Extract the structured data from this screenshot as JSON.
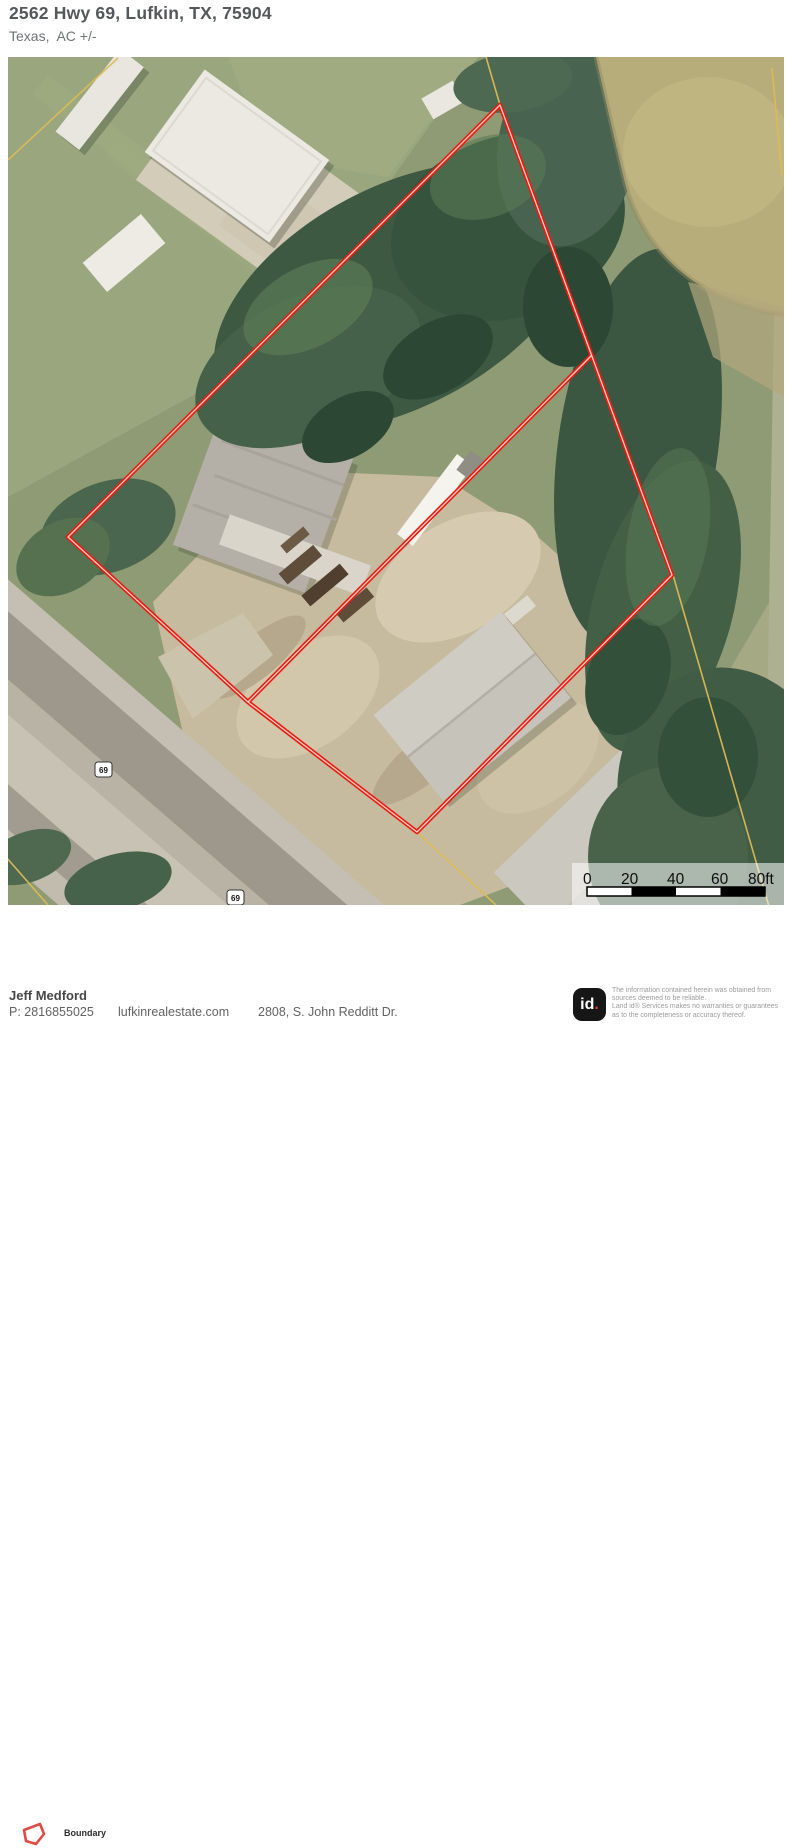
{
  "header": {
    "title": "2562 Hwy 69, Lufkin, TX, 75904",
    "subtitle": "Texas,  AC +/-"
  },
  "map": {
    "route_shield": "69",
    "scale": {
      "labels": [
        "0",
        "20",
        "40",
        "60",
        "80ft"
      ]
    }
  },
  "legend": {
    "boundary_label": "Boundary"
  },
  "footer": {
    "agent_name": "Jeff Medford",
    "phone": "P: 2816855025",
    "website": "lufkinrealestate.com",
    "address": "2808, S. John Redditt Dr.",
    "logo_text": "id",
    "logo_dot": ".",
    "disclaimer": [
      "The information contained herein was obtained from",
      "sources deemed to be reliable.",
      " Land id® Services makes no warranties or guarantees",
      "as to the completeness or accuracy thereof."
    ]
  },
  "colors": {
    "boundary_red": "#ea1c0d",
    "parcel_line_yellow": "#ddbb55",
    "pond_tan": "#b7ad7a",
    "logo_bg": "#161616",
    "logo_dot_red": "#e03c31"
  }
}
